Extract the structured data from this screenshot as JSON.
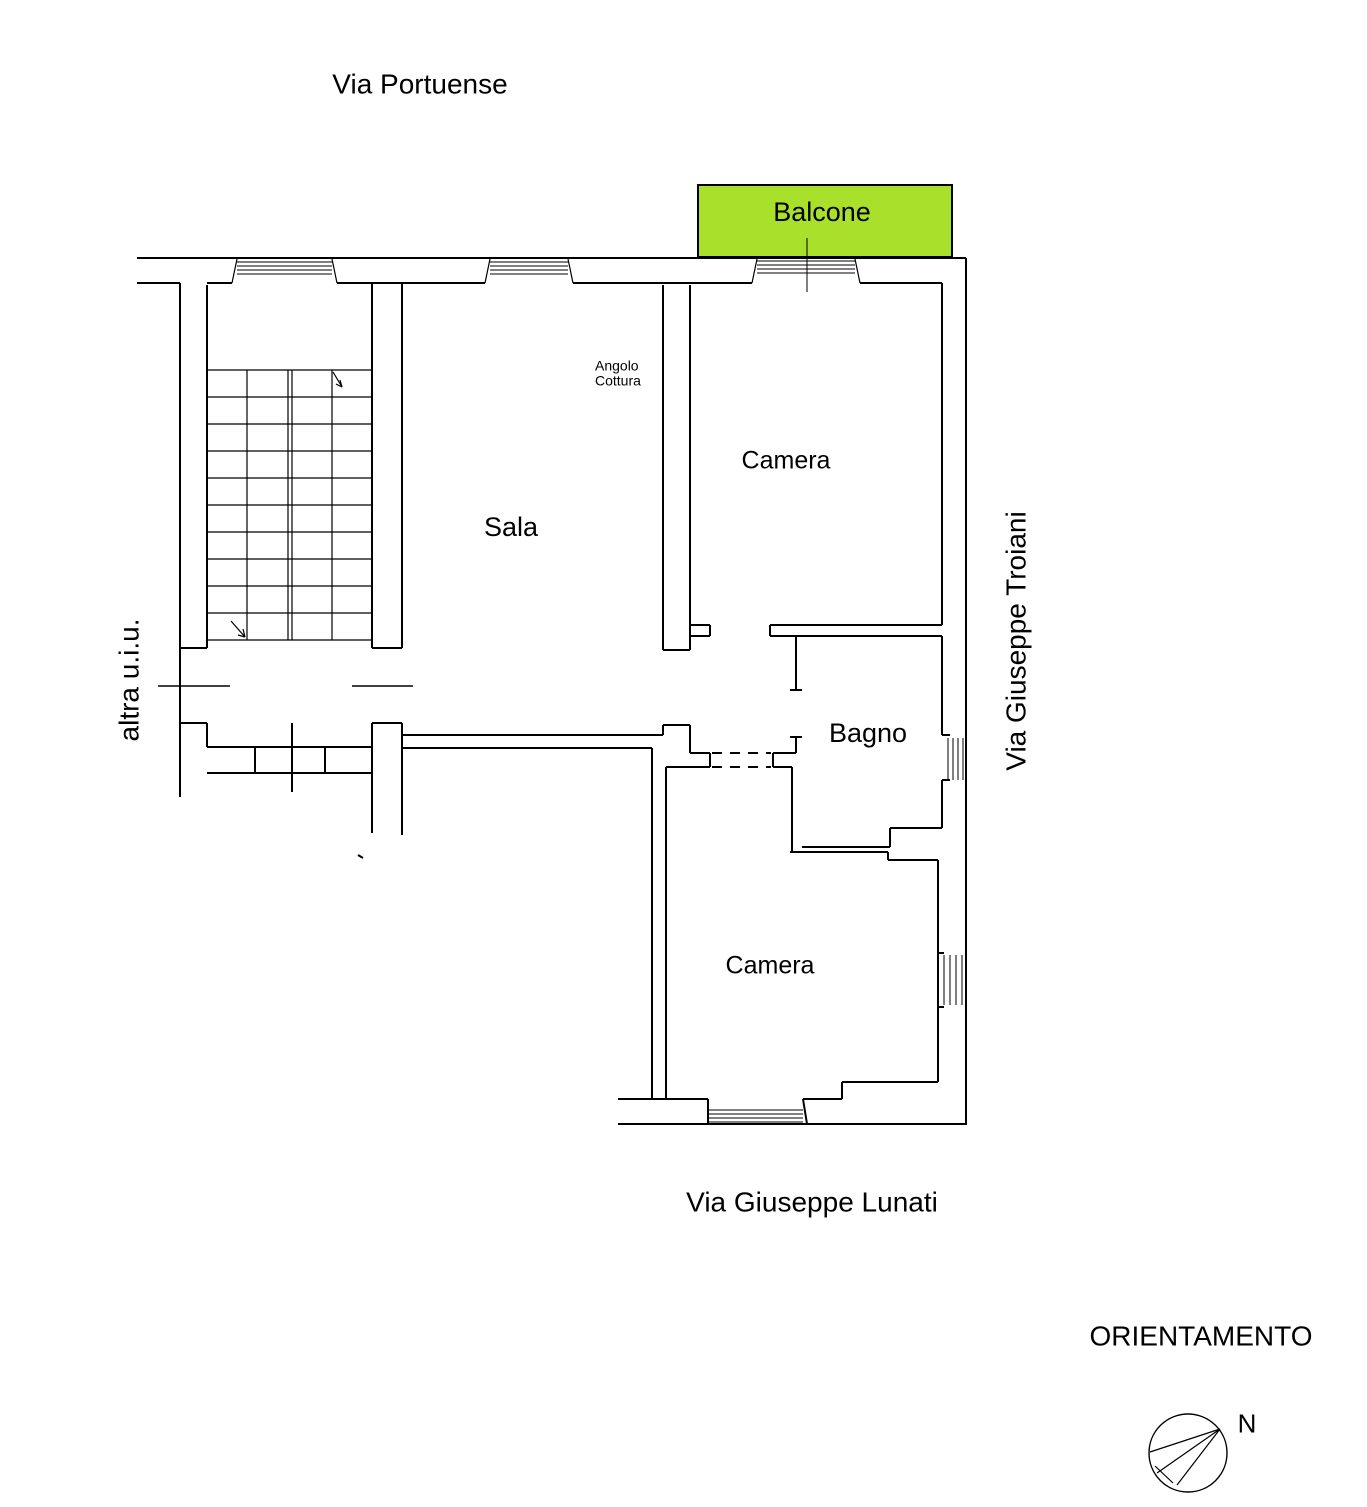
{
  "colors": {
    "background": "#FFFFFF",
    "line": "#000000",
    "balcone_fill": "#A8E02C"
  },
  "streets": {
    "top": "Via Portuense",
    "right": "Via Giuseppe Troiani",
    "bottom": "Via Giuseppe Lunati"
  },
  "rooms": {
    "balcone": "Balcone",
    "camera_top": "Camera",
    "sala": "Sala",
    "angolo_cottura": "Angolo\nCottura",
    "bagno": "Bagno",
    "camera_bottom": "Camera"
  },
  "annotations": {
    "other_unit": "altra u.i.u.",
    "orientation_title": "ORIENTAMENTO",
    "north": "N"
  }
}
